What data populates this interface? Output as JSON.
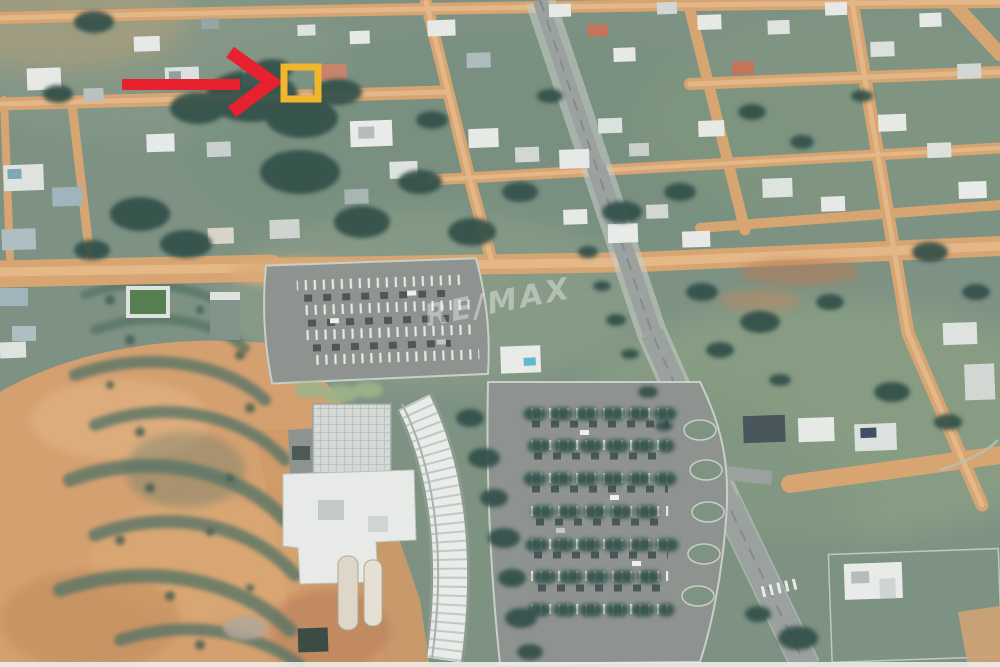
{
  "image": {
    "description": "Oblique aerial satellite photo of a residential neighborhood with dirt-road blocks, a paved avenue, an orange terraced bare-soil field, and a shopping center with tree-lined parking lots",
    "watermark": {
      "text": "RE/MAX",
      "color": "#ffffff",
      "opacity": "0.38"
    },
    "annotations": {
      "arrow": {
        "name": "location-pointer-arrow",
        "direction": "right",
        "color": "#e8212e"
      },
      "highlight_box": {
        "name": "highlighted-property-lot",
        "shape": "square-outline",
        "color": "#f1b62b"
      }
    },
    "palette": {
      "grass": "#7e9284",
      "dirt_road": "#d6a572",
      "bare_soil": "#d4a070",
      "paved_road": "#9ba19e",
      "tree_canopy": "#324f48",
      "roof_white": "#e9ebe8",
      "roof_terracotta": "#c5745a"
    }
  }
}
